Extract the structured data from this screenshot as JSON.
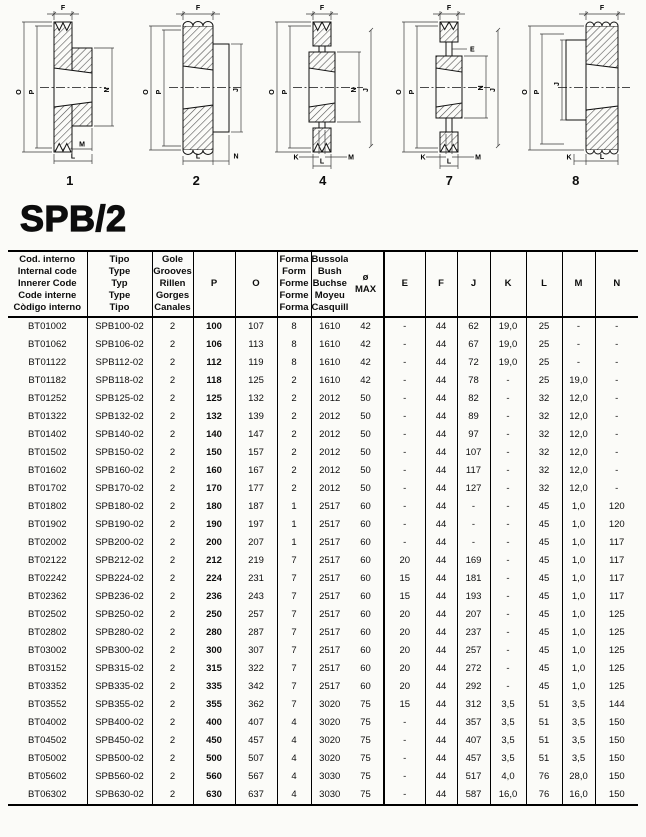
{
  "page": {
    "title": "SPB/2"
  },
  "diagrams": [
    {
      "number": "1",
      "labels": {
        "f": "F",
        "o": "O",
        "p": "P",
        "n": "N",
        "m": "M",
        "l": "L"
      }
    },
    {
      "number": "2",
      "labels": {
        "f": "F",
        "o": "O",
        "p": "P",
        "j": "J",
        "l": "L",
        "n": "N"
      }
    },
    {
      "number": "4",
      "labels": {
        "f": "F",
        "o": "O",
        "p": "P",
        "n": "N",
        "j": "J",
        "k": "K",
        "m": "M",
        "l": "L"
      }
    },
    {
      "number": "7",
      "labels": {
        "f": "F",
        "e": "E",
        "o": "O",
        "p": "P",
        "n": "N",
        "j": "J",
        "k": "K",
        "m": "M",
        "l": "L"
      }
    },
    {
      "number": "8",
      "labels": {
        "f": "F",
        "o": "O",
        "p": "P",
        "j": "J",
        "k": "K",
        "l": "L"
      }
    }
  ],
  "table": {
    "header": {
      "code": "Cod. interno\nInternal code\nInnerer Code\nCode interne\nCòdigo interno",
      "type": "Tipo\nType\nTyp\nType\nTipo",
      "grooves": "Gole\nGrooves\nRillen\nGorges\nCanales",
      "p": "P",
      "o": "O",
      "form": "Forma\nForm\nForme\nForme\nForma",
      "bush": "Bussola\nBush\nBuchse\nMoyeu\nCasquillo",
      "bush_max": "ø\nMAX",
      "e": "E",
      "f": "F",
      "j": "J",
      "k": "K",
      "l": "L",
      "m": "M",
      "n": "N"
    },
    "rows": [
      [
        "BT01002",
        "SPB100-02",
        "2",
        "100",
        "107",
        "8",
        "1610",
        "42",
        "-",
        "44",
        "62",
        "19,0",
        "25",
        "-",
        "-"
      ],
      [
        "BT01062",
        "SPB106-02",
        "2",
        "106",
        "113",
        "8",
        "1610",
        "42",
        "-",
        "44",
        "67",
        "19,0",
        "25",
        "-",
        "-"
      ],
      [
        "BT01122",
        "SPB112-02",
        "2",
        "112",
        "119",
        "8",
        "1610",
        "42",
        "-",
        "44",
        "72",
        "19,0",
        "25",
        "-",
        "-"
      ],
      [
        "BT01182",
        "SPB118-02",
        "2",
        "118",
        "125",
        "2",
        "1610",
        "42",
        "-",
        "44",
        "78",
        "-",
        "25",
        "19,0",
        "-"
      ],
      [
        "BT01252",
        "SPB125-02",
        "2",
        "125",
        "132",
        "2",
        "2012",
        "50",
        "-",
        "44",
        "82",
        "-",
        "32",
        "12,0",
        "-"
      ],
      [
        "BT01322",
        "SPB132-02",
        "2",
        "132",
        "139",
        "2",
        "2012",
        "50",
        "-",
        "44",
        "89",
        "-",
        "32",
        "12,0",
        "-"
      ],
      [
        "BT01402",
        "SPB140-02",
        "2",
        "140",
        "147",
        "2",
        "2012",
        "50",
        "-",
        "44",
        "97",
        "-",
        "32",
        "12,0",
        "-"
      ],
      [
        "BT01502",
        "SPB150-02",
        "2",
        "150",
        "157",
        "2",
        "2012",
        "50",
        "-",
        "44",
        "107",
        "-",
        "32",
        "12,0",
        "-"
      ],
      [
        "BT01602",
        "SPB160-02",
        "2",
        "160",
        "167",
        "2",
        "2012",
        "50",
        "-",
        "44",
        "117",
        "-",
        "32",
        "12,0",
        "-"
      ],
      [
        "BT01702",
        "SPB170-02",
        "2",
        "170",
        "177",
        "2",
        "2012",
        "50",
        "-",
        "44",
        "127",
        "-",
        "32",
        "12,0",
        "-"
      ],
      [
        "BT01802",
        "SPB180-02",
        "2",
        "180",
        "187",
        "1",
        "2517",
        "60",
        "-",
        "44",
        "-",
        "-",
        "45",
        "1,0",
        "120"
      ],
      [
        "BT01902",
        "SPB190-02",
        "2",
        "190",
        "197",
        "1",
        "2517",
        "60",
        "-",
        "44",
        "-",
        "-",
        "45",
        "1,0",
        "120"
      ],
      [
        "BT02002",
        "SPB200-02",
        "2",
        "200",
        "207",
        "1",
        "2517",
        "60",
        "-",
        "44",
        "-",
        "-",
        "45",
        "1,0",
        "117"
      ],
      [
        "BT02122",
        "SPB212-02",
        "2",
        "212",
        "219",
        "7",
        "2517",
        "60",
        "20",
        "44",
        "169",
        "-",
        "45",
        "1,0",
        "117"
      ],
      [
        "BT02242",
        "SPB224-02",
        "2",
        "224",
        "231",
        "7",
        "2517",
        "60",
        "15",
        "44",
        "181",
        "-",
        "45",
        "1,0",
        "117"
      ],
      [
        "BT02362",
        "SPB236-02",
        "2",
        "236",
        "243",
        "7",
        "2517",
        "60",
        "15",
        "44",
        "193",
        "-",
        "45",
        "1,0",
        "117"
      ],
      [
        "BT02502",
        "SPB250-02",
        "2",
        "250",
        "257",
        "7",
        "2517",
        "60",
        "20",
        "44",
        "207",
        "-",
        "45",
        "1,0",
        "125"
      ],
      [
        "BT02802",
        "SPB280-02",
        "2",
        "280",
        "287",
        "7",
        "2517",
        "60",
        "20",
        "44",
        "237",
        "-",
        "45",
        "1,0",
        "125"
      ],
      [
        "BT03002",
        "SPB300-02",
        "2",
        "300",
        "307",
        "7",
        "2517",
        "60",
        "20",
        "44",
        "257",
        "-",
        "45",
        "1,0",
        "125"
      ],
      [
        "BT03152",
        "SPB315-02",
        "2",
        "315",
        "322",
        "7",
        "2517",
        "60",
        "20",
        "44",
        "272",
        "-",
        "45",
        "1,0",
        "125"
      ],
      [
        "BT03352",
        "SPB335-02",
        "2",
        "335",
        "342",
        "7",
        "2517",
        "60",
        "20",
        "44",
        "292",
        "-",
        "45",
        "1,0",
        "125"
      ],
      [
        "BT03552",
        "SPB355-02",
        "2",
        "355",
        "362",
        "7",
        "3020",
        "75",
        "15",
        "44",
        "312",
        "3,5",
        "51",
        "3,5",
        "144"
      ],
      [
        "BT04002",
        "SPB400-02",
        "2",
        "400",
        "407",
        "4",
        "3020",
        "75",
        "-",
        "44",
        "357",
        "3,5",
        "51",
        "3,5",
        "150"
      ],
      [
        "BT04502",
        "SPB450-02",
        "2",
        "450",
        "457",
        "4",
        "3020",
        "75",
        "-",
        "44",
        "407",
        "3,5",
        "51",
        "3,5",
        "150"
      ],
      [
        "BT05002",
        "SPB500-02",
        "2",
        "500",
        "507",
        "4",
        "3020",
        "75",
        "-",
        "44",
        "457",
        "3,5",
        "51",
        "3,5",
        "150"
      ],
      [
        "BT05602",
        "SPB560-02",
        "2",
        "560",
        "567",
        "4",
        "3030",
        "75",
        "-",
        "44",
        "517",
        "4,0",
        "76",
        "28,0",
        "150"
      ],
      [
        "BT06302",
        "SPB630-02",
        "2",
        "630",
        "637",
        "4",
        "3030",
        "75",
        "-",
        "44",
        "587",
        "16,0",
        "76",
        "16,0",
        "150"
      ]
    ]
  }
}
